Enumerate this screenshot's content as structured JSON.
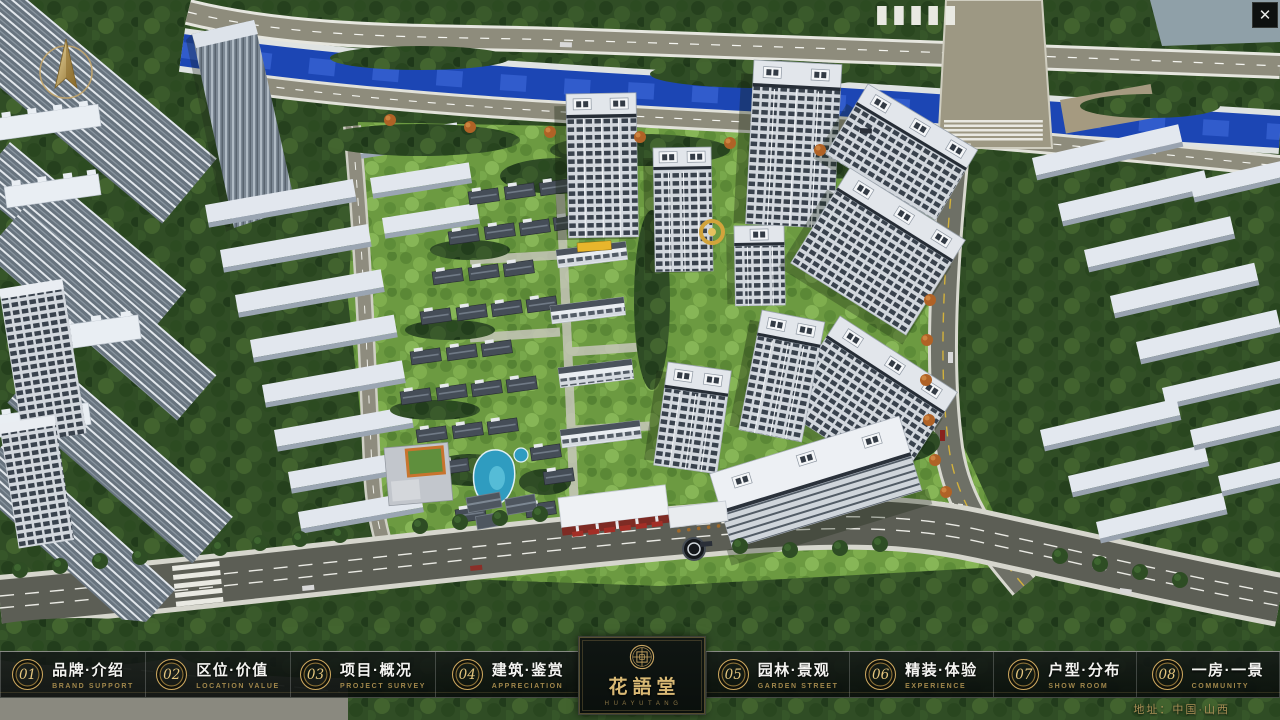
{
  "app": {
    "close_glyph": "✕"
  },
  "nav": {
    "items": [
      {
        "num": "01",
        "zh": "品牌·介绍",
        "en": "BRAND SUPPORT"
      },
      {
        "num": "02",
        "zh": "区位·价值",
        "en": "LOCATION VALUE"
      },
      {
        "num": "03",
        "zh": "项目·概况",
        "en": "PROJECT SURVEY"
      },
      {
        "num": "04",
        "zh": "建筑·鉴赏",
        "en": "APPRECIATION"
      },
      {
        "num": "05",
        "zh": "园林·景观",
        "en": "GARDEN STREET"
      },
      {
        "num": "06",
        "zh": "精装·体验",
        "en": "EXPERIENCE"
      },
      {
        "num": "07",
        "zh": "户型·分布",
        "en": "SHOW ROOM"
      },
      {
        "num": "08",
        "zh": "一房·一景",
        "en": "COMMUNITY"
      }
    ]
  },
  "logo": {
    "title": "花語堂",
    "subtitle": "H U A  Y U  T A N G"
  },
  "footer": {
    "address": "地址：中国·山西"
  },
  "icons": {
    "compass": "north-compass",
    "close": "close-icon",
    "emblem": "seal-emblem"
  },
  "colors": {
    "gold": "#c9a562",
    "navbar_bg": "#0a0f0c",
    "river": "#1c46b4",
    "lawn": "#6c9a41"
  }
}
